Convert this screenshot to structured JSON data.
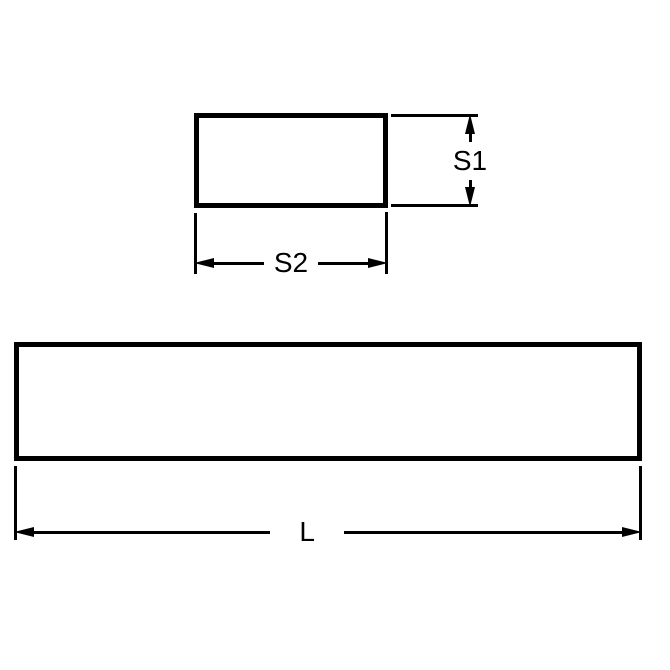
{
  "colors": {
    "line": "#000000",
    "background": "#ffffff"
  },
  "drawing": {
    "type": "technical-dimension-drawing",
    "end_view": {
      "shape": "rectangle",
      "height_dimension_label": "S1",
      "width_dimension_label": "S2"
    },
    "side_view": {
      "shape": "rectangle",
      "length_dimension_label": "L"
    }
  }
}
